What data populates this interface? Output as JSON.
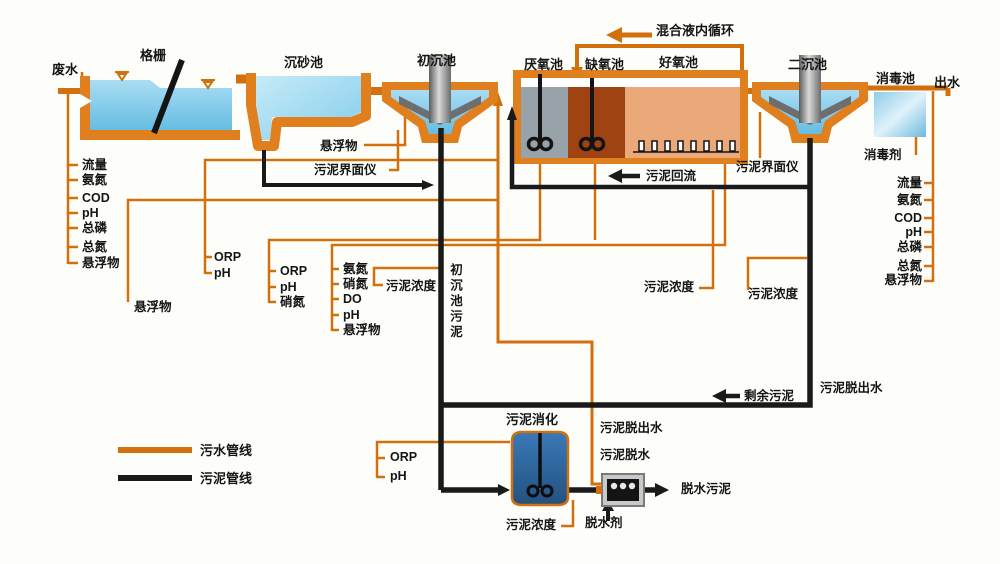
{
  "colors": {
    "sewage_pipe_orange": "#d2700e",
    "sludge_pipe_black": "#1a1a1a",
    "water_blue": "#7cc4e8",
    "anaerobic_gray": "#98a3a9",
    "anoxic_rust": "#a04313",
    "aerobic_salmon": "#eba878",
    "digester_blue": "#2d68a8"
  },
  "streams": {
    "influent": "废水",
    "effluent": "出水",
    "recirculation": "混合液内循环",
    "sludge_return": "污泥回流",
    "excess_sludge": "剩余污泥",
    "primary_sludge_vertical": "初沉池污泥",
    "dewatering_filtrate_right": "污泥脱出水",
    "dewatering_filtrate_mid": "污泥脱出水",
    "sludge_dewatering": "污泥脱水",
    "dewatered_sludge": "脱水污泥",
    "dewatering_agent": "脱水剂",
    "disinfectant": "消毒剂"
  },
  "tanks": {
    "screen": "格栅",
    "grit": "沉砂池",
    "primary": "初沉池",
    "anaerobic": "厌氧池",
    "anoxic": "缺氧池",
    "aerobic": "好氧池",
    "secondary": "二沉池",
    "disinfection": "消毒池",
    "digester": "污泥消化"
  },
  "sensors": {
    "influent_list": {
      "items": [
        "流量",
        "氨氮",
        "COD",
        "pH",
        "总磷",
        "总氮",
        "悬浮物"
      ]
    },
    "effluent_list": {
      "items": [
        "流量",
        "氨氮",
        "COD",
        "pH",
        "总磷",
        "总氮",
        "悬浮物"
      ]
    },
    "influent_ss": "悬浮物",
    "grit_effluent_ss": "悬浮物",
    "primary_interface_meter": "污泥界面仪",
    "secondary_interface_meter": "污泥界面仪",
    "anaerobic_list": {
      "items": [
        "ORP",
        "pH"
      ]
    },
    "anoxic_list": {
      "items": [
        "ORP",
        "pH",
        "硝氮"
      ]
    },
    "aerobic_list": {
      "items": [
        "氨氮",
        "硝氮",
        "DO",
        "pH",
        "悬浮物"
      ]
    },
    "primary_sludge_conc": "污泥浓度",
    "return_sludge_conc": "污泥浓度",
    "excess_sludge_conc": "污泥浓度",
    "digester_list": {
      "items": [
        "ORP",
        "pH"
      ]
    },
    "digester_conc": "污泥浓度"
  },
  "legend": {
    "sewage_line": "污水管线",
    "sludge_line": "污泥管线"
  }
}
